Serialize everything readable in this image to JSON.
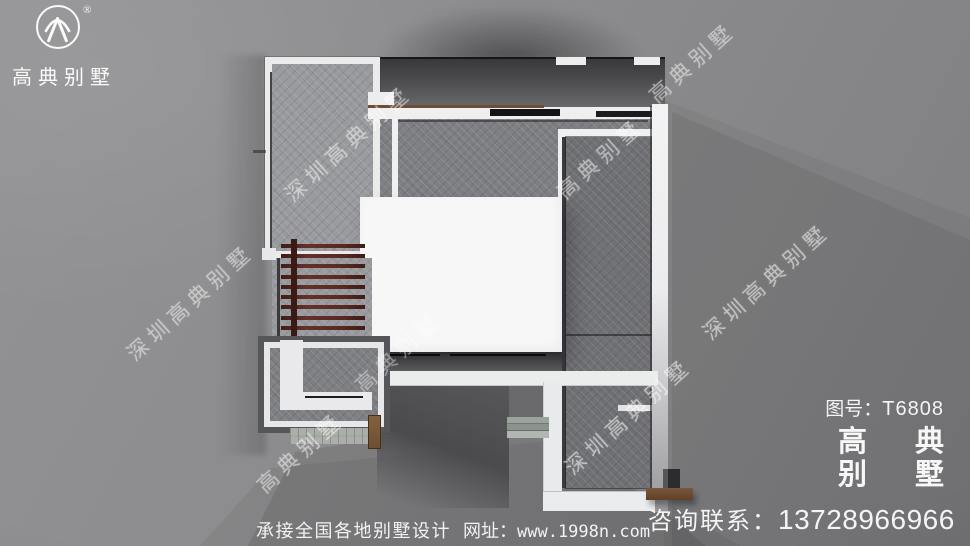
{
  "logo": {
    "brand": "高典别墅",
    "registered": "®"
  },
  "watermark": {
    "long": "深圳高典别墅",
    "short": "高典别墅"
  },
  "info_panel": {
    "drawing_label": "图号：",
    "drawing_number": "T6808",
    "brand_line1_char1": "高",
    "brand_line1_char2": "典",
    "brand_line2_char1": "别",
    "brand_line2_char2": "墅",
    "contact_label": "咨询联系：",
    "contact_phone": "13728966966"
  },
  "footer": {
    "service_text": "承接全国各地别墅设计",
    "site_label": "网址：",
    "site_url": "www.1998n.com"
  },
  "colors": {
    "background": "#8a8a8c",
    "roof_texture": "#7f8084",
    "parapet_white": "#efeff0",
    "pergola_wood": "#5a2a22",
    "deck_wood": "#6e4f33",
    "watermark_white": "#ffffff",
    "text_white": "#f4f4f5"
  }
}
